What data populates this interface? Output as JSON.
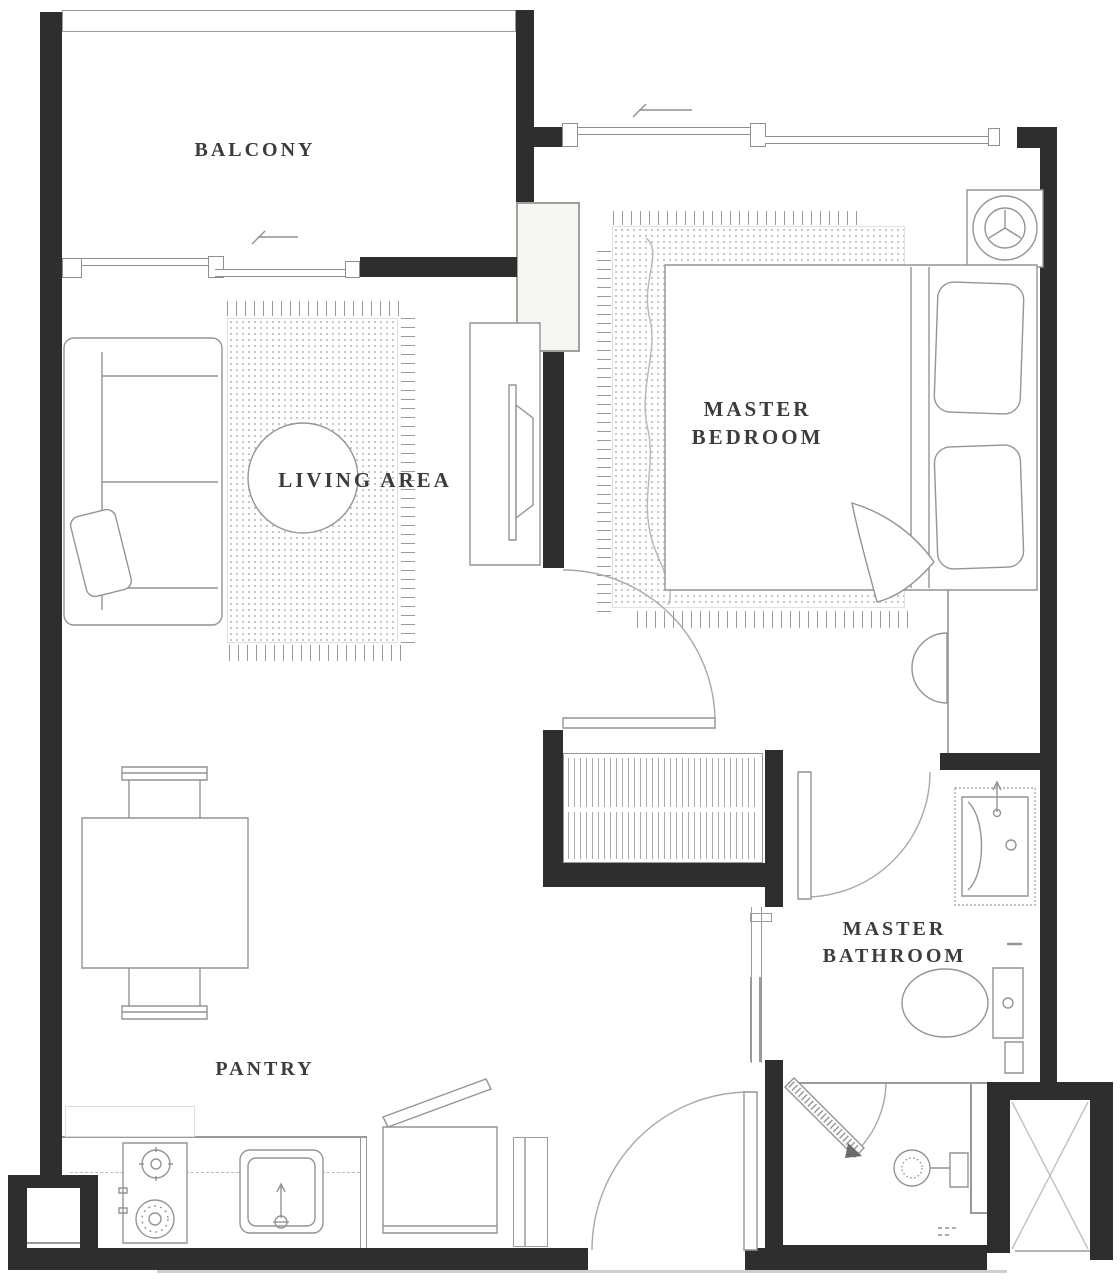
{
  "rooms": {
    "balcony": {
      "label": "BALCONY"
    },
    "living_area": {
      "label": "LIVING AREA"
    },
    "master_bedroom": {
      "line1": "MASTER",
      "line2": "BEDROOM"
    },
    "master_bathroom": {
      "line1": "MASTER",
      "line2": "BATHROOM"
    },
    "pantry": {
      "label": "PANTRY"
    }
  },
  "colors": {
    "wall": "#2e2e2e",
    "line": "#979797",
    "light_line": "#c4c4c4",
    "text": "#3c3c3c",
    "background": "#ffffff"
  },
  "fixtures": [
    "sofa",
    "throw-pillow",
    "round-coffee-table",
    "living-rug",
    "tv-console",
    "dining-table",
    "dining-chairs",
    "kitchen-counter",
    "two-burner-stove",
    "kitchen-sink",
    "refrigerator-with-open-door",
    "tall-cabinet",
    "double-bed",
    "bed-pillows",
    "bed-throw",
    "bedroom-rug",
    "washing-machine",
    "wardrobe-hanging-clothes",
    "bathroom-vanity-sink",
    "toilet",
    "shelf",
    "shower-door",
    "shower-fixture",
    "service-shaft",
    "entrance-door-swing",
    "bedroom-door-swing",
    "bathroom-door-swing",
    "sliding-window-balcony",
    "sliding-window-bedroom",
    "structural-column"
  ]
}
